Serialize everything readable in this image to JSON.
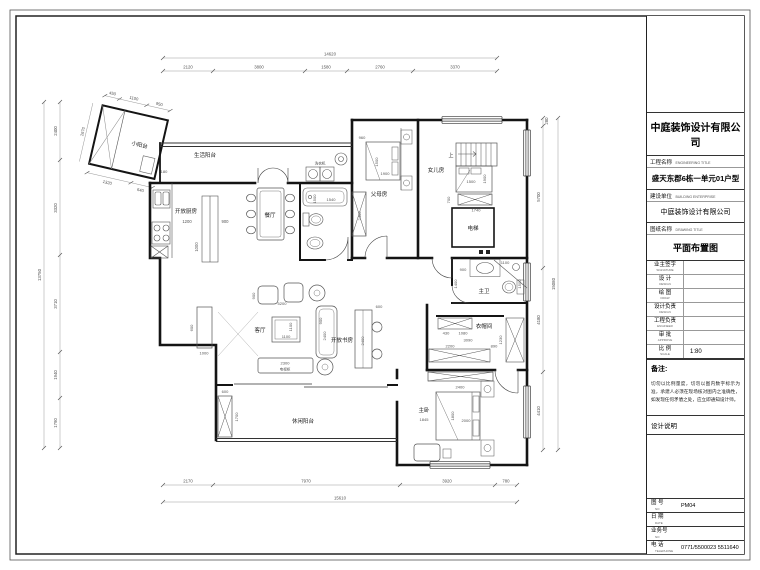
{
  "title_block": {
    "company": "中庭装饰设计有限公司",
    "project_label": "工程名称",
    "project_label_en": "ENGINEERING TITLE",
    "project_name": "盛天东郡6栋一单元01户型",
    "client_label": "建设单位",
    "client_label_en": "BUILDING ENTERPRISE",
    "client_name": "中庭装饰设计有限公司",
    "drawing_label": "图纸名称",
    "drawing_label_en": "DRAWING TITLE",
    "drawing_name": "平面布置图",
    "rows": [
      {
        "label": "业主签字",
        "en": "SIGNATURE",
        "value": ""
      },
      {
        "label": "设  计",
        "en": "DESIGN",
        "value": ""
      },
      {
        "label": "绘  图",
        "en": "DRAW",
        "value": ""
      },
      {
        "label": "设计负责",
        "en": "DESIGN",
        "value": ""
      },
      {
        "label": "工程负责",
        "en": "ENGINEER",
        "value": ""
      },
      {
        "label": "审  批",
        "en": "APPROVE",
        "value": ""
      },
      {
        "label": "比  例",
        "en": "SCALE",
        "value": "1:80"
      }
    ],
    "notes_label": "备注:",
    "notes_text": "切勿以比例量度，切勿以图内数字标示为准，承建人必须在现场核对图内之准确性，如发现任何矛盾之处，应立即通知设计师。",
    "design_note_label": "设计说明",
    "sheet_no_label": "图 号",
    "sheet_no_en": "NO",
    "sheet_no": "PM04",
    "date_label": "日 期",
    "date_en": "DATE",
    "date_value": "",
    "job_no_label": "业务号",
    "job_no_en": "NO",
    "job_no": "",
    "phone_label": "电 话",
    "phone_en": "TELEPHONE",
    "phone": "0771/5500023  5511640"
  },
  "rooms": {
    "small_balcony": "小阳台",
    "service_balcony": "生活阳台",
    "open_kitchen": "开放厨房",
    "dining": "餐厅",
    "parents_room": "父母房",
    "daughter_room": "女儿房",
    "living": "客厅",
    "open_study": "开放书房",
    "leisure_balcony": "休闲阳台",
    "master_bedroom": "主卧",
    "master_bath": "主卫",
    "cloakroom": "衣帽间",
    "elevator": "电梯",
    "stairs_up": "上",
    "washer": "洗衣机",
    "tv_cabinet": "电视柜"
  },
  "dims": {
    "top_total": "14620",
    "top": [
      "2120",
      "3800",
      "1580",
      "2760",
      "3370"
    ],
    "bottom": [
      "2170",
      "7970",
      "3920",
      "780"
    ],
    "bottom_total": "15610",
    "left": [
      "2400",
      "3320",
      "3710",
      "1940",
      "1790"
    ],
    "left_total": "13750",
    "right": [
      "280",
      "5700",
      "4180",
      "4410"
    ],
    "right_total": "15080",
    "balcony_top": [
      "450",
      "1100",
      "950"
    ],
    "balcony_side": "2670",
    "balcony_bottom": [
      "1320",
      "640"
    ],
    "balcony_inner": "1180"
  },
  "fd": {
    "kitchen_a": "1200",
    "kitchen_b": "900",
    "kitchen_c": "1000",
    "parents_a": "960",
    "parents_w": "1500",
    "parents_l": "1900",
    "parents_ward": "2400",
    "daughter_w": "1500",
    "daughter_l": "1900",
    "daughter_ward": "1740",
    "daughter_side": "700",
    "bath_a": "1500",
    "bath_b": "1540",
    "living_width": "5200",
    "table_a": "1100",
    "table_b": "1100",
    "chair_a": "900",
    "sofa_l": "2400",
    "sofa_w": "900",
    "tv_l": "2300",
    "console_a": "1000",
    "console_b": "600",
    "study_a": "2400",
    "study_b": "600",
    "leisure_a": "600",
    "leisure_b": "1700",
    "mbath_a": "900",
    "mbath_b": "1400",
    "mbath_c": "1100",
    "mbath_d": "1500",
    "cloak_a": "430",
    "cloak_b": "1080",
    "cloak_c": "3090",
    "cloak_d": "2200",
    "cloak_e": "890",
    "cloak_f": "1230",
    "master_ward": "2400",
    "master_bed_w": "1800",
    "master_bed_l": "2000",
    "master_wall": "1845"
  }
}
